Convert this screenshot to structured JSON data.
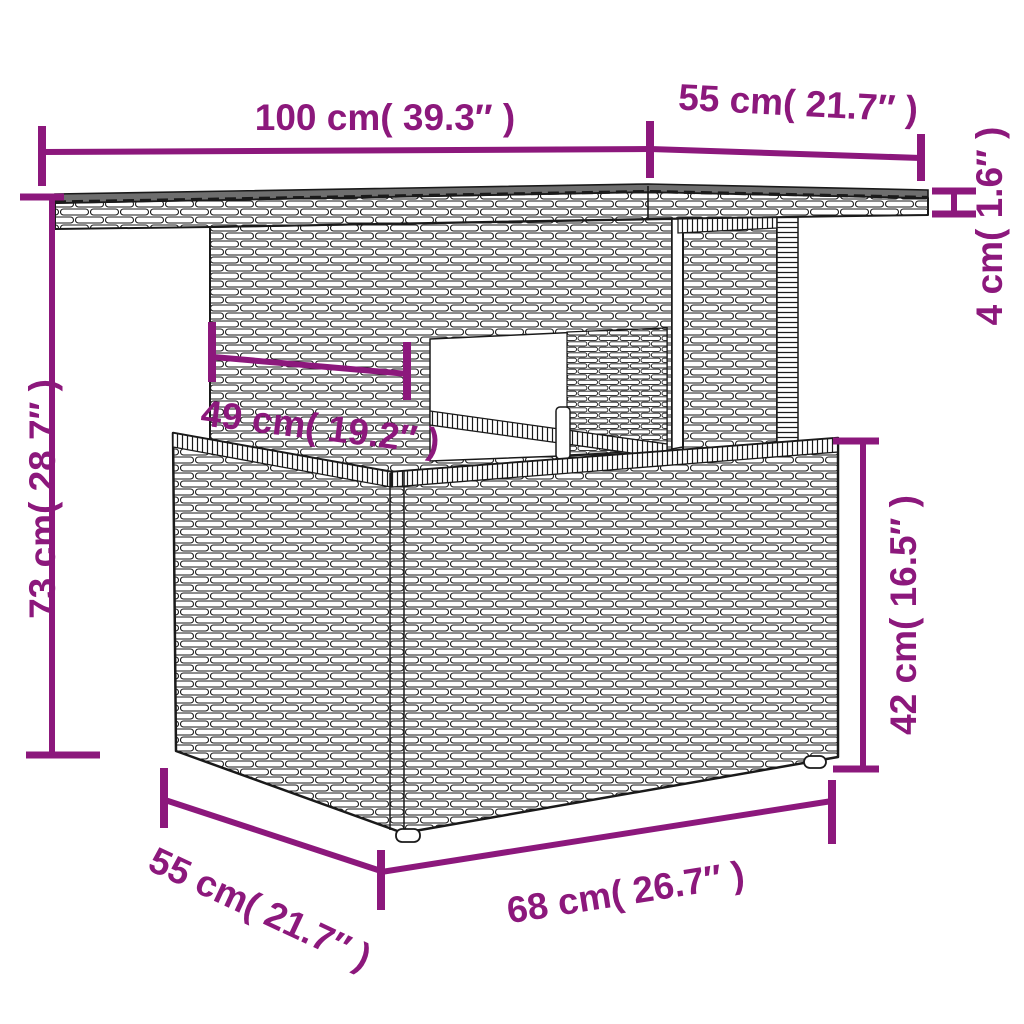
{
  "accent_color": "#8C187C",
  "diagram": {
    "type": "product-dimension-diagram",
    "dimensions": {
      "top_length": {
        "label": "100 cm( 39.3″ )"
      },
      "top_depth": {
        "label": "55 cm( 21.7″ )"
      },
      "top_thickness": {
        "label": "4 cm( 1.6″ )"
      },
      "total_height": {
        "label": "73 cm( 28.7″ )"
      },
      "pedestal_width": {
        "label": "49 cm( 19.2″ )"
      },
      "base_height": {
        "label": "42 cm( 16.5″ )"
      },
      "base_depth": {
        "label": "55 cm( 21.7″ )"
      },
      "base_length": {
        "label": "68 cm( 26.7″ )"
      }
    }
  }
}
